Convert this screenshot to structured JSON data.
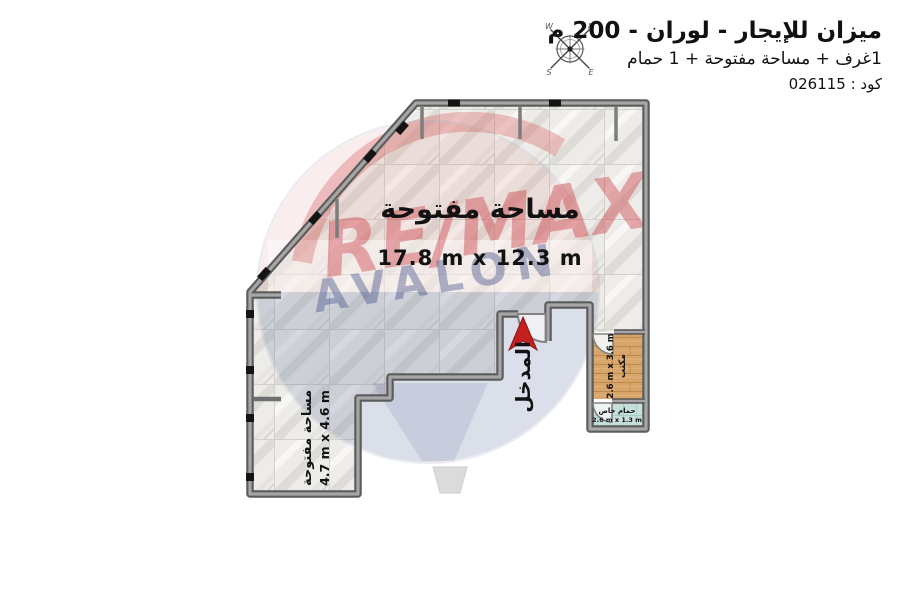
{
  "header": {
    "title": "ميزان للإيجار - لوران - 200 م",
    "subtitle": "1غرف + مساحة مفتوحة + 1 حمام",
    "code": "كود : 026115"
  },
  "compass": {
    "n": "N",
    "e": "E",
    "s": "S",
    "w": "W"
  },
  "watermark": {
    "brand": "RE/MAX",
    "office": "AVALON"
  },
  "areas": {
    "main": {
      "label": "مساحة مفتوحة",
      "dims": "17.8 m x 12.3 m"
    },
    "secondary": {
      "label": "مساحة مفتوحة",
      "dims": "4.7 m x 4.6 m"
    },
    "entrance": {
      "label": "المدخل"
    },
    "office": {
      "label": "مكتب",
      "dims": "2.6 m x 3.6 m"
    },
    "bathroom": {
      "label": "حمام خاص",
      "dims": "2.6 m x 1.3 m"
    }
  },
  "colors": {
    "wall": "#5c5c5c",
    "wall_core": "#a6a6a6",
    "arrow_red": "#c32020",
    "wood": "#d8a56a",
    "bath_floor": "#c5dfdb",
    "brand_red": "#cf3f46",
    "brand_navy": "#44538a"
  }
}
